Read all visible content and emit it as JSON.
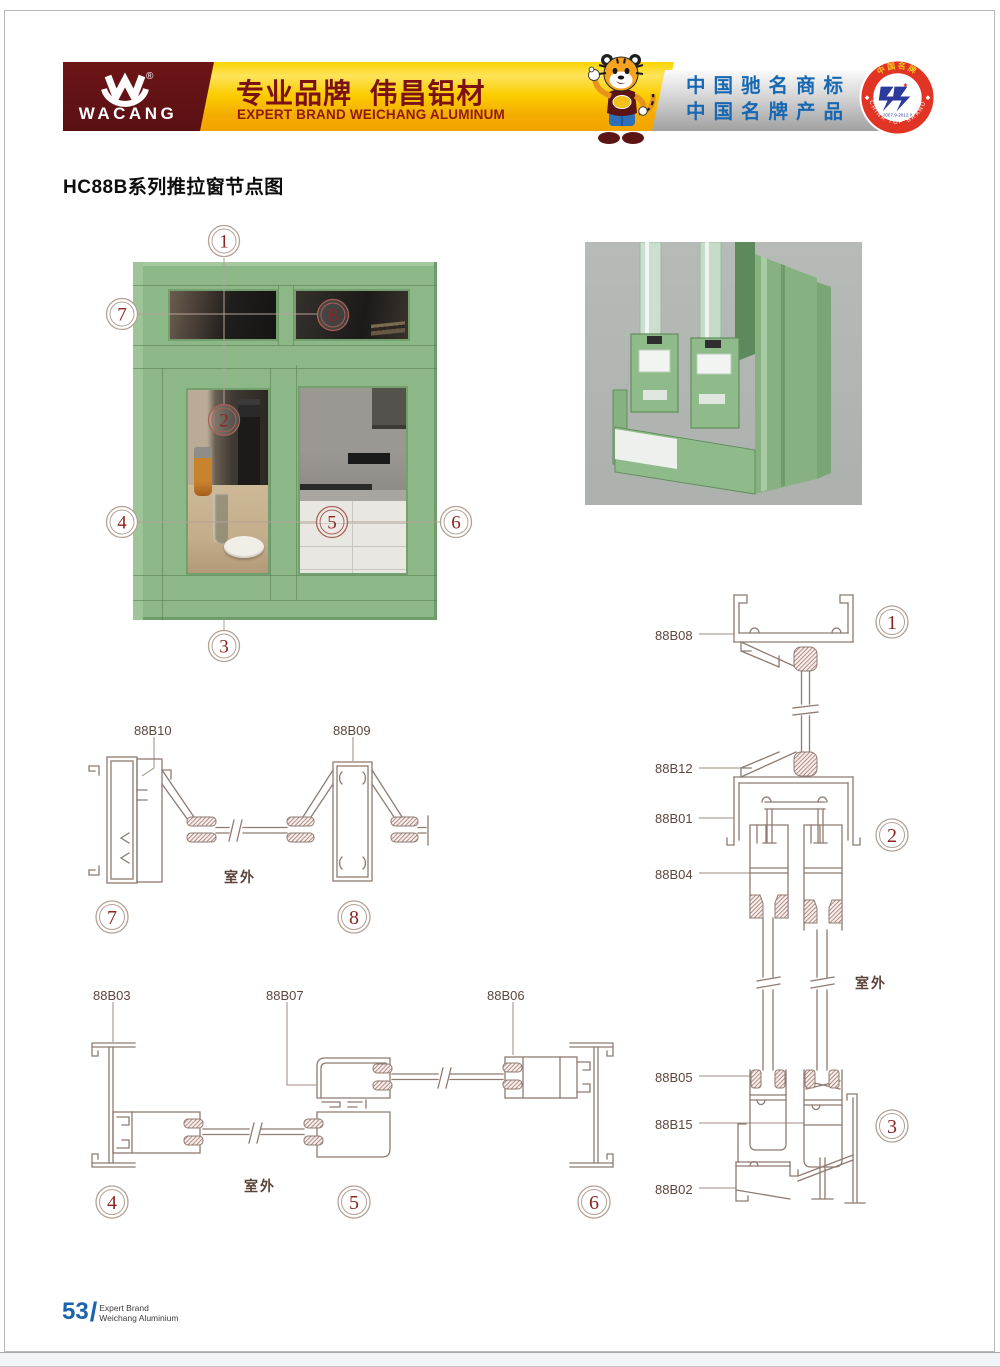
{
  "header": {
    "brand": "WACANG",
    "reg_mark": "®",
    "slogan_cn": "专业品牌  伟昌铝材",
    "slogan_en": "EXPERT BRAND WEICHANG ALUMINUM",
    "honor_line1": "中国驰名商标",
    "honor_line2": "中国名牌产品",
    "badge": {
      "arc_top": "中国名牌",
      "arc_bottom": "CHINA TOP BRAND",
      "years": "2007.9-2012.9"
    }
  },
  "page_title": "HC88B系列推拉窗节点图",
  "outdoor_label": "室外",
  "photo_callouts": {
    "c1": "1",
    "c2": "2",
    "c3": "3",
    "c4": "4",
    "c5": "5",
    "c6": "6",
    "c7": "7",
    "c8": "8"
  },
  "sections": {
    "horizontal_top": {
      "labels": {
        "l1": "88B10",
        "l2": "88B09"
      },
      "circles": {
        "c7": "7",
        "c8": "8"
      }
    },
    "horizontal_bottom": {
      "labels": {
        "l1": "88B03",
        "l2": "88B07",
        "l3": "88B06"
      },
      "circles": {
        "c4": "4",
        "c5": "5",
        "c6": "6"
      }
    },
    "vertical": {
      "labels": {
        "l1": "88B08",
        "l2": "88B12",
        "l3": "88B01",
        "l4": "88B04",
        "l5": "88B05",
        "l6": "88B15",
        "l7": "88B02"
      },
      "circles": {
        "c1": "1",
        "c2": "2",
        "c3": "3"
      }
    }
  },
  "footer": {
    "page_number": "53",
    "divider": "/",
    "line1": "Expert Brand",
    "line2": "Weichang Aluminium"
  },
  "colors": {
    "brand_maroon": "#5f1416",
    "banner_gold": "#fbcc00",
    "honor_blue": "#1767b1",
    "badge_red": "#e23424",
    "drawing_line": "#8e7b71",
    "accent_red": "#8b2522",
    "window_green": "#8cb888",
    "footer_blue": "#1a63b0"
  }
}
